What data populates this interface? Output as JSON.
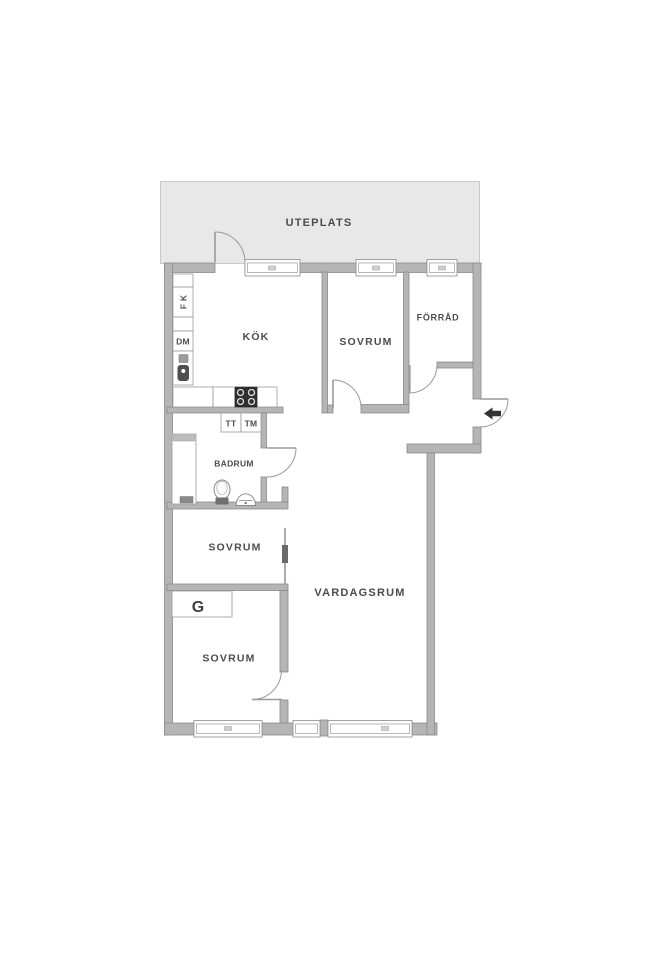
{
  "outdoor": {
    "label": "UTEPLATS"
  },
  "rooms": {
    "kitchen": "KÖK",
    "bedroom_top": "SOVRUM",
    "storage": "FÖRRÅD",
    "bathroom": "BADRUM",
    "bedroom_mid": "SOVRUM",
    "bedroom_bottom": "SOVRUM",
    "living_room": "VARDAGSRUM"
  },
  "fixtures": {
    "fridge_freezer": "F K",
    "dishwasher": "DM",
    "dryer": "TT",
    "washing_machine": "TM",
    "wardrobe": "G"
  },
  "colors": {
    "wall_fill": "#b5b5b5",
    "wall_stroke": "#8b8b8b",
    "patio_fill": "#e8e8e8",
    "label_color": "#4c4c4c",
    "stove_color": "#2f2f2f",
    "arrow_color": "#333333",
    "sliding_door": "#6a6a6a"
  }
}
